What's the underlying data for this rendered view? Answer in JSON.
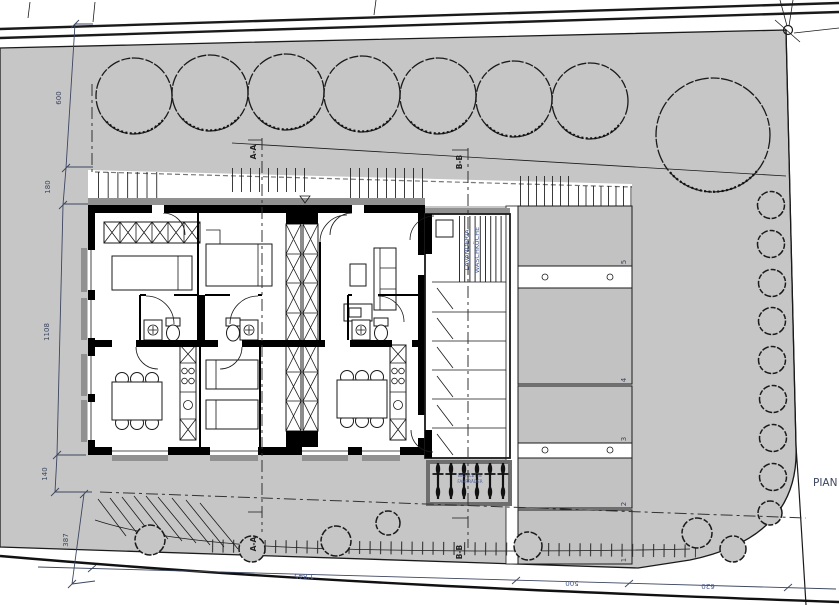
{
  "drawing": {
    "sheet_label_partial": "PIAN",
    "dims": {
      "d600": "600",
      "d180": "180",
      "d1108": "1108",
      "d140": "140",
      "d387": "387",
      "d1845": "1'845",
      "d500": "500",
      "d620": "620"
    },
    "sections": {
      "aa": "A-A",
      "bb": "B-B"
    },
    "laundry": {
      "it": "LAVANDERIA",
      "de": "WASCHKÜCHE"
    },
    "bikes": {
      "line1": "BICICLETTE",
      "line2": "FAHRRÄDER"
    },
    "parking": {
      "s1": "1",
      "s2": "2",
      "s3": "3",
      "s4": "4",
      "s5": "5"
    },
    "colors": {
      "site_gray": "#c6c6c6",
      "stall_gray": "#c2c2c2",
      "dark_band": "#919191",
      "annotation_blue": "#4a5d93",
      "ink": "#1a1a1a"
    }
  }
}
